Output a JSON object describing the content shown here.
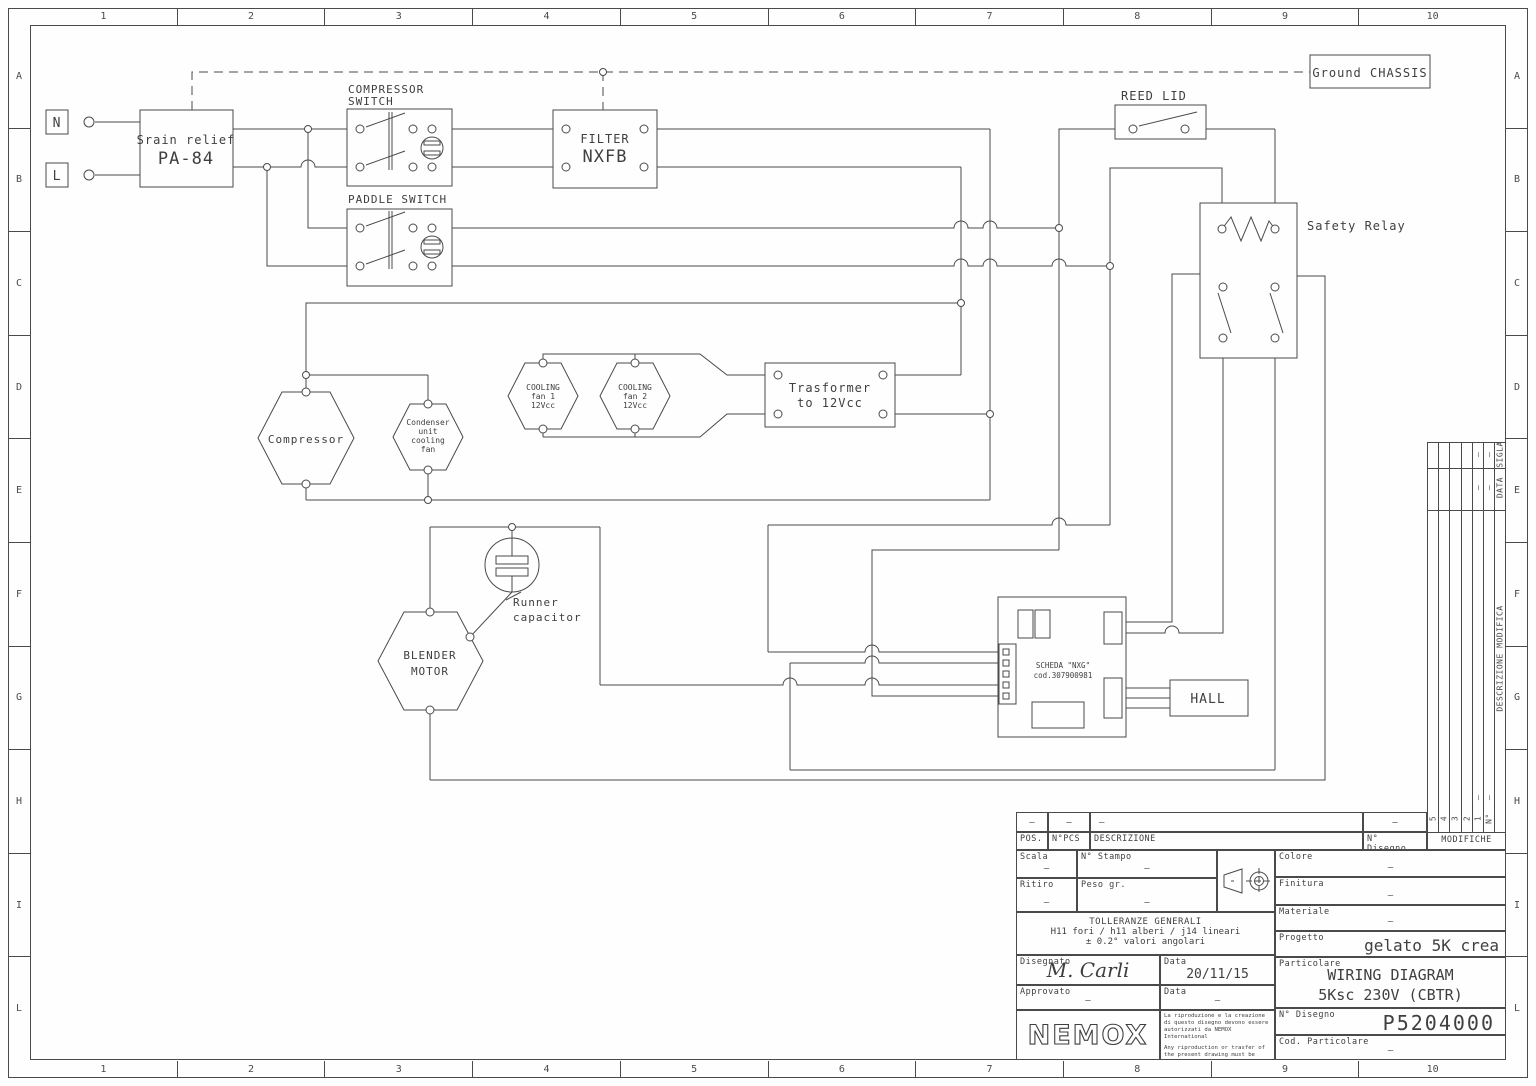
{
  "frame": {
    "columns": [
      "1",
      "2",
      "3",
      "4",
      "5",
      "6",
      "7",
      "8",
      "9",
      "10"
    ],
    "rows": [
      "A",
      "B",
      "C",
      "D",
      "E",
      "F",
      "G",
      "H",
      "I",
      "L"
    ]
  },
  "diagram": {
    "terminal_n": "N",
    "terminal_l": "L",
    "strain_relief_l1": "Srain relief",
    "strain_relief_l2": "PA-84",
    "compressor_switch_l1": "COMPRESSOR",
    "compressor_switch_l2": "SWITCH",
    "paddle_switch": "PADDLE SWITCH",
    "filter_l1": "FILTER",
    "filter_l2": "NXFB",
    "ground_chassis": "Ground CHASSIS",
    "reed_lid": "REED LID",
    "safety_relay": "Safety Relay",
    "compressor": "Compressor",
    "condenser_l1": "Condenser",
    "condenser_l2": "unit",
    "condenser_l3": "cooling",
    "condenser_l4": "fan",
    "fan1_l1": "COOLING",
    "fan1_l2": "fan 1",
    "fan1_l3": "12Vcc",
    "fan2_l1": "COOLING",
    "fan2_l2": "fan 2",
    "fan2_l3": "12Vcc",
    "transformer_l1": "Trasformer",
    "transformer_l2": "to 12Vcc",
    "runner_capacitor_l1": "Runner",
    "runner_capacitor_l2": "capacitor",
    "blender_l1": "BLENDER",
    "blender_l2": "MOTOR",
    "scheda_l1": "SCHEDA \"NXG\"",
    "scheda_l2": "cod.307900981",
    "hall": "HALL"
  },
  "title_block": {
    "pos": "POS.",
    "npcs": "N°PCS",
    "descrizione": "DESCRIZIONE",
    "n_disegno": "N° Disegno",
    "modifiche": "MODIFICHE",
    "rev_cols": [
      "5",
      "4",
      "3",
      "2",
      "1",
      "N°"
    ],
    "rev_sigla": "SIGLA",
    "rev_data": "DATA",
    "rev_desc": "DESCRIZIONE  MODIFICA",
    "scala": "Scala",
    "n_stampo": "N° Stampo",
    "ritiro": "Ritiro",
    "peso": "Peso gr.",
    "colore": "Colore",
    "finitura": "Finitura",
    "materiale": "Materiale",
    "progetto": "Progetto",
    "progetto_value": "gelato 5K crea",
    "particolare": "Particolare",
    "particolare_value1": "WIRING DIAGRAM",
    "particolare_value2": "5Ksc 230V (CBTR)",
    "tolleranze_l1": "TOLLERANZE GENERALI",
    "tolleranze_l2": "H11 fori / h11 alberi / j14 lineari",
    "tolleranze_l3": "± 0.2° valori angolari",
    "disegnato": "Disegnato",
    "disegnato_value": "M. Carli",
    "data_label": "Data",
    "data_value": "20/11/15",
    "approvato": "Approvato",
    "data2_label": "Data",
    "n_disegno2": "N° Disegno",
    "n_disegno_value": "P5204000",
    "cod_particolare": "Cod. Particolare",
    "logo": "NEMOX",
    "disclaimer_it": "La riproduzione e la creazione di questo disegno devono essere autorizzati da NEMOX International",
    "disclaimer_en": "Any riproduction or trasfer of the present drawing must be autorized by NEMOX International",
    "dash": "—"
  }
}
